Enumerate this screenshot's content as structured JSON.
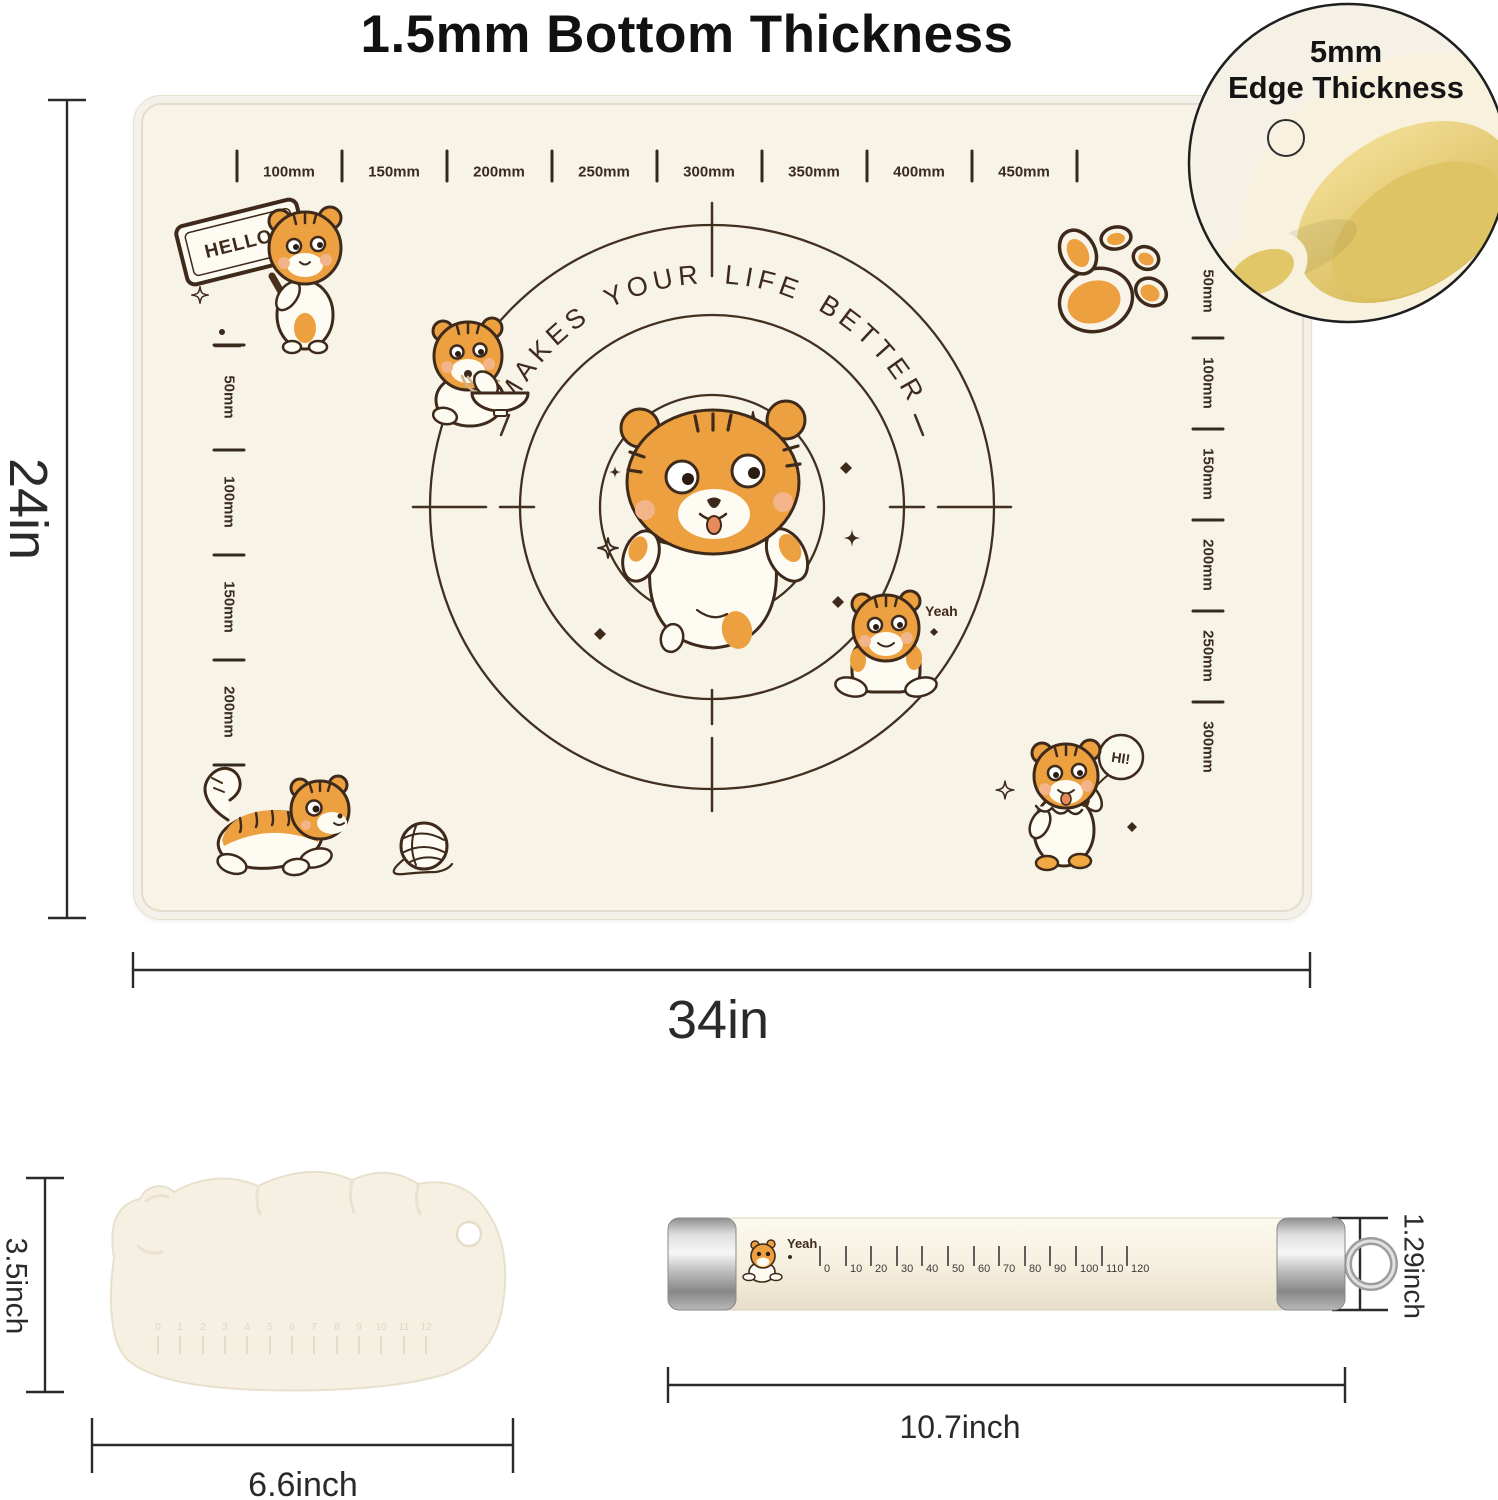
{
  "title": "1.5mm Bottom Thickness",
  "inset": {
    "line1": "5mm",
    "line2": "Edge Thickness"
  },
  "mat": {
    "slogan": "MAKES YOUR LIFE BETTER",
    "hello_sign": "HELLO!",
    "yeah_label": "Yeah",
    "hi_label": "HI!",
    "ruler_top": [
      "100mm",
      "150mm",
      "200mm",
      "250mm",
      "300mm",
      "350mm",
      "400mm",
      "450mm"
    ],
    "ruler_left": [
      "50mm",
      "100mm",
      "150mm",
      "200mm"
    ],
    "ruler_right": [
      "50mm",
      "100mm",
      "150mm",
      "200mm",
      "250mm",
      "300mm"
    ],
    "height_label": "24in",
    "width_label": "34in"
  },
  "scraper": {
    "height_label": "3.5inch",
    "width_label": "6.6inch",
    "scale": [
      "0",
      "1",
      "2",
      "3",
      "4",
      "5",
      "6",
      "7",
      "8",
      "9",
      "10",
      "11",
      "12"
    ]
  },
  "pin": {
    "yeah_label": "Yeah",
    "scale": [
      "0",
      "10",
      "20",
      "30",
      "40",
      "50",
      "60",
      "70",
      "80",
      "90",
      "100",
      "110",
      "120"
    ],
    "diameter_label": "1.29inch",
    "length_label": "10.7inch"
  },
  "palette": {
    "mat_cream": "#F8F3E7",
    "tiger_orange": "#EDA03F",
    "line_brown": "#3E2A1B",
    "dimension_ink": "#2A2A2A",
    "metal_gray": "#C0C0C0",
    "inset_inner_yellow": "#E3C96B"
  }
}
